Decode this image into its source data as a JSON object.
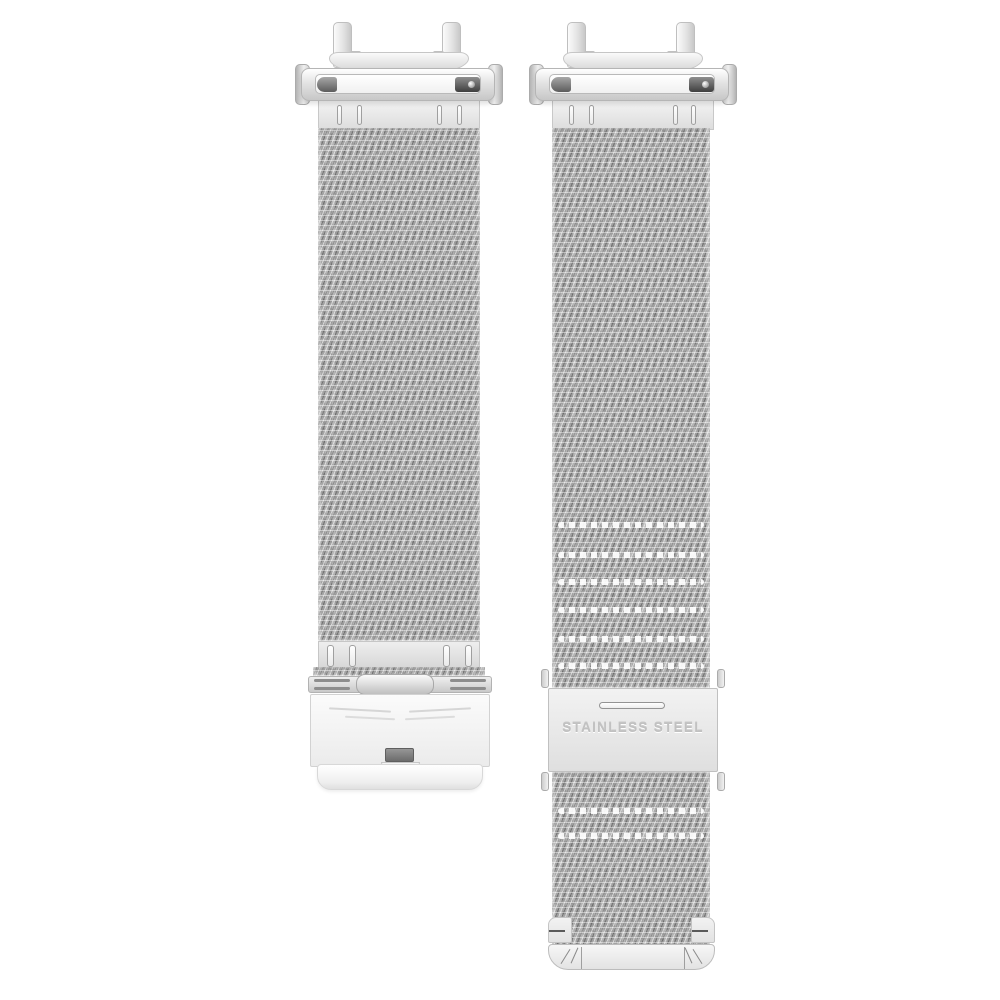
{
  "scene": {
    "type": "product-photo",
    "subject": "Two-piece stainless steel Milanese mesh watch band: left strap with fold-over clasp, right strap with slide buckle",
    "background_color": "#ffffff"
  },
  "left_strap": {
    "parts": [
      "lug-connector",
      "spring-bar-housing",
      "slotted-end-plate",
      "milanese-mesh-band",
      "lower-slotted-plate",
      "hinge",
      "fold-over-clasp-plate",
      "release-button",
      "clasp-under-band"
    ]
  },
  "right_strap": {
    "parts": [
      "lug-connector",
      "spring-bar-housing",
      "slotted-end-plate",
      "milanese-mesh-band",
      "slide-buckle",
      "buckle-slot",
      "side-release-tabs",
      "mesh-tail",
      "rounded-tip-cap"
    ],
    "buckle_engraving": "STAINLESS STEEL"
  },
  "colors": {
    "steel_light": "#f5f5f5",
    "steel_mid": "#d9d9d9",
    "mesh_base": "#a2a2a2",
    "mesh_highlight": "#ffffff",
    "mesh_shadow": "#666666",
    "engraving_text": "#c1c1c1",
    "release_button_dark": "#6c6c6c"
  }
}
